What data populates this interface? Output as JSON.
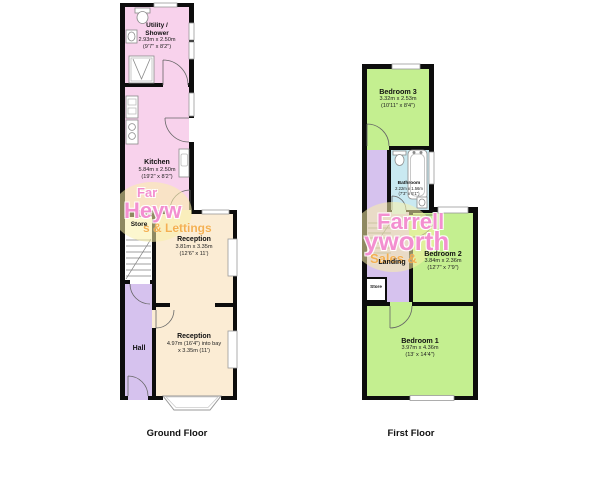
{
  "colors": {
    "wall": "#0d0d0d",
    "utility_kitchen_pink": "#f8d2ec",
    "hall_landing_lavender": "#d6c2ee",
    "reception_cream": "#fbecd4",
    "bedroom_green": "#c4ef90",
    "bathroom_blue": "#c9e9f1",
    "store_white": "#ffffff",
    "watermark_pink": "#ee64be",
    "watermark_orange": "#f1a030",
    "watermark_yellow": "#f9f0a8"
  },
  "ground_floor": {
    "title": "Ground Floor",
    "rooms": {
      "utility": {
        "line1": "Utility /",
        "line2": "Shower",
        "metric": "2.93m x 2.50m",
        "imperial": "(9'7\" x 8'2\")"
      },
      "kitchen": {
        "name": "Kitchen",
        "metric": "5.84m x 2.50m",
        "imperial": "(19'2\" x 8'2\")"
      },
      "store": {
        "name": "Store"
      },
      "hall": {
        "name": "Hall"
      },
      "reception1": {
        "name": "Reception",
        "metric": "3.81m x 3.35m",
        "imperial": "(12'6\" x 11')"
      },
      "reception2": {
        "name": "Reception",
        "metric": "4.97m (16'4\") into bay",
        "imperial": "x 3.35m (11')"
      }
    },
    "watermark": {
      "line1": "Far",
      "line2": "Heyw",
      "line3": "s & Lettings"
    }
  },
  "first_floor": {
    "title": "First Floor",
    "rooms": {
      "bedroom3": {
        "name": "Bedroom 3",
        "metric": "3.32m x 2.53m",
        "imperial": "(10'11\" x 8'4\")"
      },
      "bathroom": {
        "name": "Bathroom",
        "metric": "2.22m x 1.56m",
        "imperial": "(7'3\" x 5'1\")"
      },
      "landing": {
        "name": "Landing"
      },
      "store": {
        "name": "Store"
      },
      "bedroom2": {
        "name": "Bedroom 2",
        "metric": "3.84m x 2.36m",
        "imperial": "(12'7\" x 7'9\")"
      },
      "bedroom1": {
        "name": "Bedroom 1",
        "metric": "3.97m x 4.36m",
        "imperial": "(13' x 14'4\")"
      }
    },
    "watermark": {
      "line1": "Farrell",
      "line2": "yworth",
      "line3": "Sales &"
    }
  }
}
